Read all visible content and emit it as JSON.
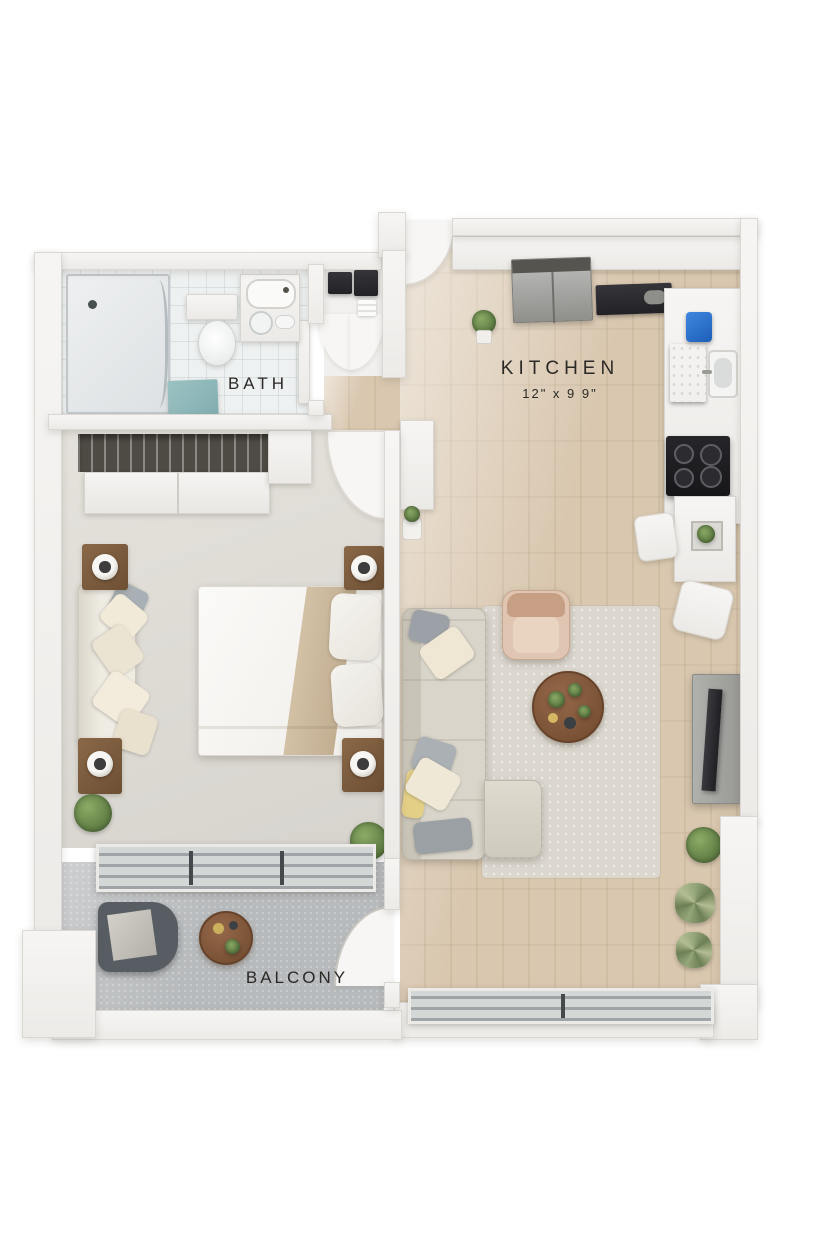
{
  "image": {
    "type": "3d-floor-plan-render",
    "background": "#ffffff"
  },
  "rooms": {
    "kitchen": {
      "label": "KITCHEN",
      "dimensions": "12\" x 9 9\"",
      "floor": "light-wood-plank",
      "items": [
        "upper-cabinets",
        "refrigerator",
        "cooktop-counter",
        "blue-countertop-appliance",
        "built-in-appliance-panel",
        "sink-with-faucet",
        "four-burner-stove",
        "dining-table-with-planter",
        "dining-chair",
        "ottoman",
        "potted-plant"
      ]
    },
    "bath": {
      "label": "BATH",
      "floor": "white-tile",
      "items": [
        "walk-in-shower",
        "toilet",
        "vanity-with-sink",
        "teal-bath-mat",
        "laundry-appliances",
        "folded-towels",
        "bath-door"
      ]
    },
    "bedroom": {
      "floor": "light-grey-carpet",
      "items": [
        "sliding-door-closet",
        "hanging-rod",
        "double-bed",
        "pillows",
        "throw-blanket",
        "cushioned-bench",
        "nightstand-with-lamp",
        "nightstand-with-lamp",
        "nightstand-with-lamp",
        "nightstand-with-lamp",
        "potted-plant",
        "potted-plant"
      ]
    },
    "living": {
      "floor": "light-wood-plank",
      "items": [
        "l-shaped-sectional-sofa",
        "throw-pillows",
        "accent-armchair",
        "round-coffee-table",
        "area-rug",
        "tv-console-with-tv",
        "hall-console",
        "potted-plants"
      ]
    },
    "balcony": {
      "label": "BALCONY",
      "floor": "concrete",
      "items": [
        "lounge-chair",
        "round-side-table",
        "glass-sliding-door",
        "door-swing"
      ]
    }
  },
  "colors": {
    "wood_floor": "#d5c3ab",
    "carpet": "#dfdcd6",
    "tile": "#eef1f1",
    "concrete": "#b8bbbd",
    "wall": "#f3f2f0",
    "bath_mat_teal": "#8fb9bb",
    "appliance_blue": "#2b72d0",
    "plant_green": "#6f8f52",
    "furniture_wood": "#7b5b3f",
    "label_text": "#2b2926"
  }
}
